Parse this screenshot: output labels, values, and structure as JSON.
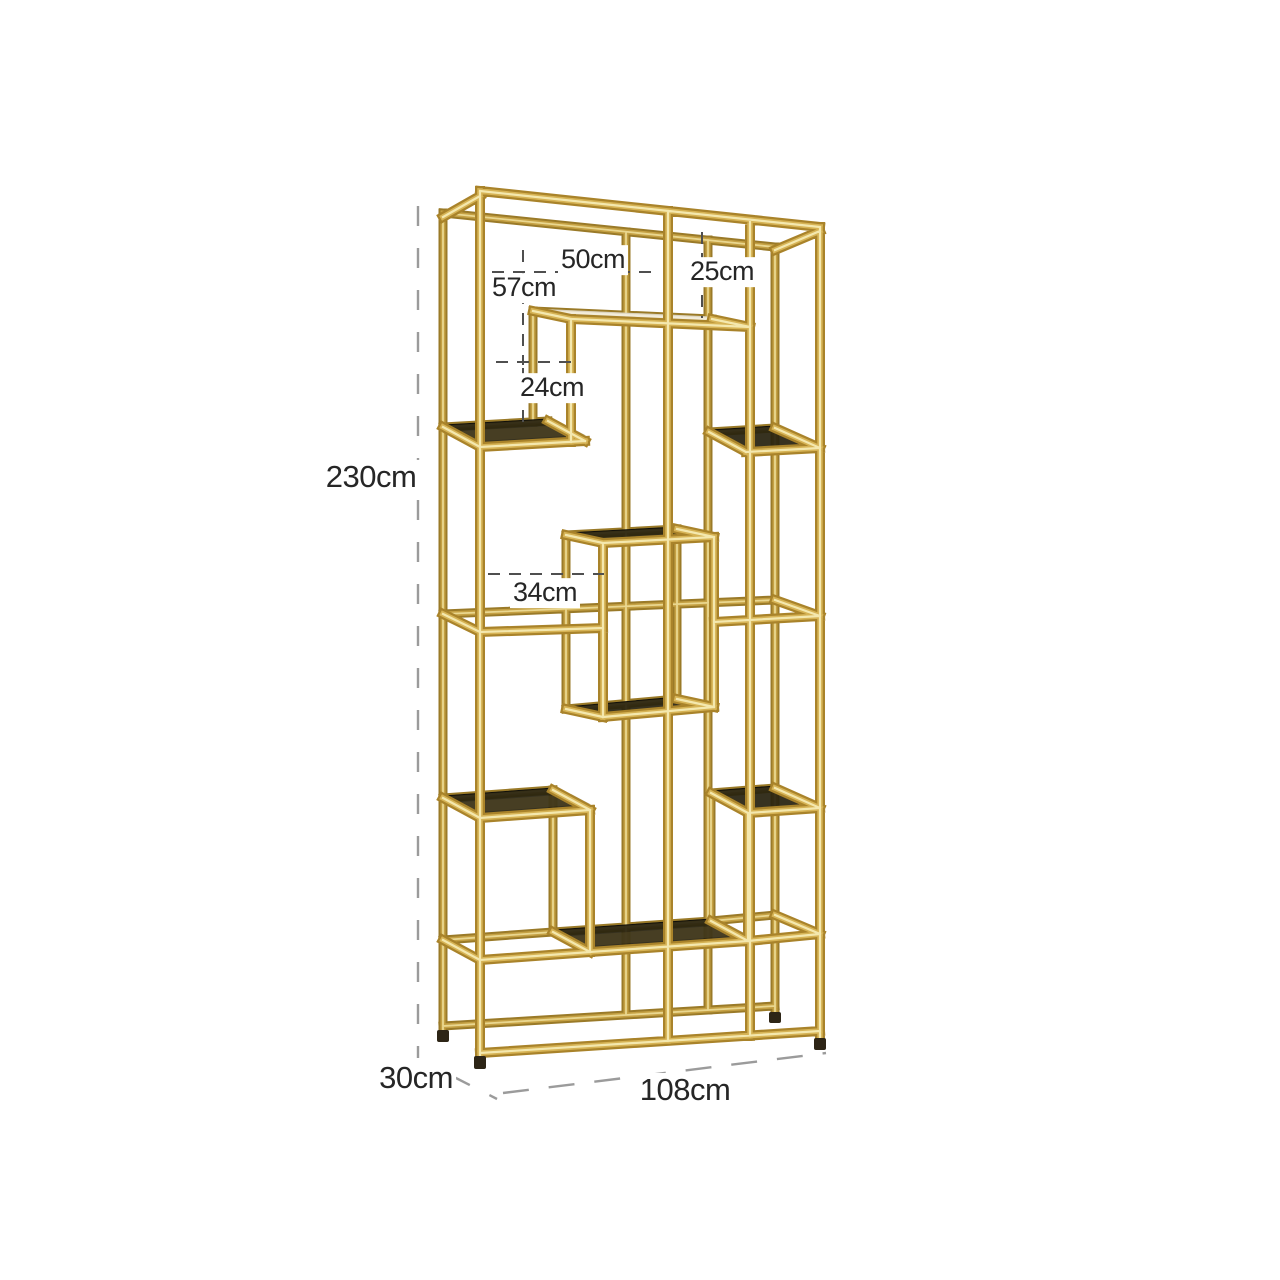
{
  "diagram": {
    "subject": "Gold display cabinet with smoked glass shelves - dimension drawing",
    "background_hex": "#ffffff",
    "frame_gold_hex": "#c8a23d",
    "frame_highlight_hex": "#f4e8ae",
    "glass_hex": "#28220f",
    "dim_line_dark_hex": "#4f4f4f",
    "dim_line_gray_hex": "#9b9b9b",
    "dim_text_hex": "#262626"
  },
  "dims": {
    "d50": {
      "label": "50cm",
      "value_cm": 50,
      "role": "inner-width-top"
    },
    "d25": {
      "label": "25cm",
      "value_cm": 25,
      "role": "top-drop-height"
    },
    "d57": {
      "label": "57cm",
      "value_cm": 57,
      "role": "upper-section-height"
    },
    "d24": {
      "label": "24cm",
      "value_cm": 24,
      "role": "upper-shelf-gap"
    },
    "d230": {
      "label": "230cm",
      "value_cm": 230,
      "role": "overall-height"
    },
    "d34": {
      "label": "34cm",
      "value_cm": 34,
      "role": "middle-box-gap"
    },
    "d30": {
      "label": "30cm",
      "value_cm": 30,
      "role": "overall-depth"
    },
    "d108": {
      "label": "108cm",
      "value_cm": 108,
      "role": "overall-width"
    }
  }
}
